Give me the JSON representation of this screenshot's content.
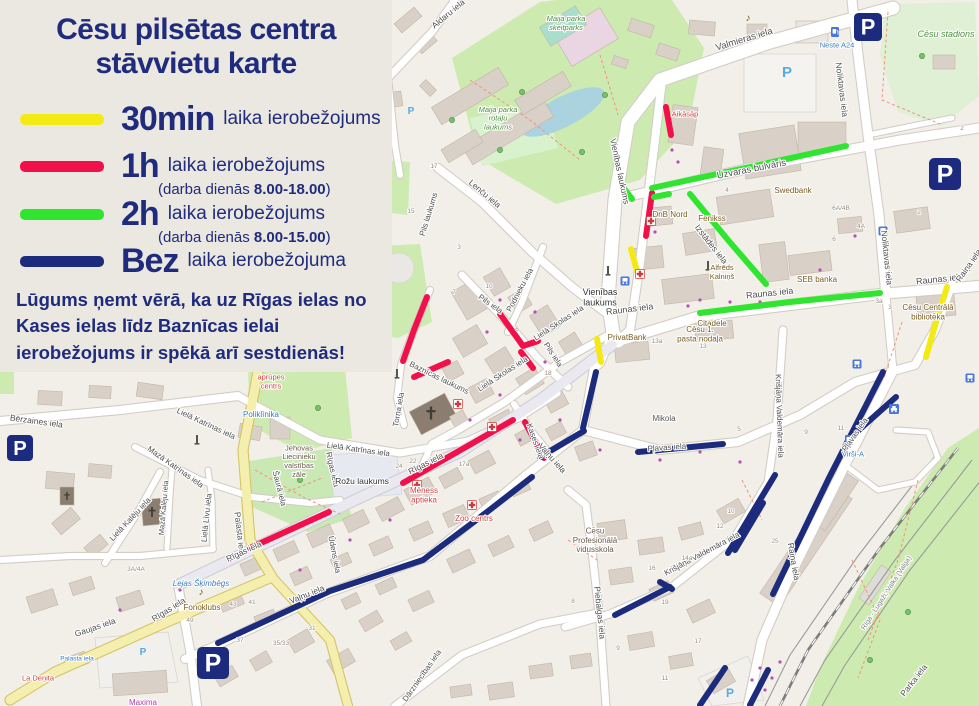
{
  "legend": {
    "title_line1": "Cēsu pilsētas centra",
    "title_line2": "stāvvietu karte",
    "items": [
      {
        "key": "30min",
        "color": "#f3ea15",
        "label_big": "30min",
        "label_rest": "laika ierobežojums"
      },
      {
        "key": "1h",
        "color": "#f2104a",
        "label_big": "1h",
        "label_rest": "laika ierobežojums",
        "note_pre": "(darba dienās ",
        "note_bold": "8.00-18.00",
        "note_post": ")"
      },
      {
        "key": "2h",
        "color": "#2fe52f",
        "label_big": "2h",
        "label_rest": "laika ierobežojums",
        "note_pre": "(darba dienās ",
        "note_bold": "8.00-15.00",
        "note_post": ")"
      },
      {
        "key": "bez",
        "color": "#1d2b7c",
        "label_big": "Bez",
        "label_rest": "laika ierobežojuma"
      }
    ],
    "note": "Lūgums ņemt vērā, ka uz Rīgas ielas no Kases ielas līdz Baznīcas ielai ierobežojums ir spēkā arī sestdienās!"
  },
  "colors": {
    "30min": "#f3ea15",
    "1h": "#f2104a",
    "2h": "#2fe52f",
    "bez": "#1d2b7c",
    "panel": "#ebe7e1",
    "navy_text": "#1f2c7d"
  },
  "map": {
    "parking_segments": [
      {
        "k": "30min",
        "p": [
          [
            631,
            249
          ],
          [
            637,
            271
          ]
        ]
      },
      {
        "k": "30min",
        "p": [
          [
            597,
            339
          ],
          [
            601,
            362
          ]
        ]
      },
      {
        "k": "30min",
        "p": [
          [
            947,
            287
          ],
          [
            936,
            322
          ],
          [
            926,
            357
          ]
        ]
      },
      {
        "k": "1h",
        "p": [
          [
            427,
            297
          ],
          [
            414,
            330
          ],
          [
            403,
            361
          ]
        ]
      },
      {
        "k": "1h",
        "p": [
          [
            414,
            377
          ],
          [
            448,
            362
          ]
        ]
      },
      {
        "k": "1h",
        "p": [
          [
            500,
            314
          ],
          [
            523,
            346
          ],
          [
            538,
            341
          ]
        ]
      },
      {
        "k": "1h",
        "p": [
          [
            521,
            352
          ],
          [
            533,
            368
          ]
        ]
      },
      {
        "k": "1h",
        "p": [
          [
            403,
            483
          ],
          [
            513,
            420
          ]
        ]
      },
      {
        "k": "1h",
        "p": [
          [
            525,
            422
          ],
          [
            544,
            458
          ]
        ]
      },
      {
        "k": "1h",
        "p": [
          [
            250,
            548
          ],
          [
            329,
            512
          ]
        ]
      },
      {
        "k": "1h",
        "p": [
          [
            666,
            107
          ],
          [
            671,
            135
          ]
        ]
      },
      {
        "k": "1h",
        "p": [
          [
            652,
            193
          ],
          [
            646,
            236
          ]
        ]
      },
      {
        "k": "2h",
        "p": [
          [
            652,
            188
          ],
          [
            750,
            167
          ],
          [
            846,
            146
          ]
        ]
      },
      {
        "k": "2h",
        "p": [
          [
            654,
            197
          ],
          [
            669,
            194
          ]
        ]
      },
      {
        "k": "2h",
        "p": [
          [
            622,
            186
          ],
          [
            632,
            199
          ]
        ]
      },
      {
        "k": "2h",
        "p": [
          [
            690,
            194
          ],
          [
            728,
            240
          ],
          [
            766,
            284
          ]
        ]
      },
      {
        "k": "2h",
        "p": [
          [
            700,
            313
          ],
          [
            790,
            302
          ],
          [
            880,
            293
          ]
        ]
      },
      {
        "k": "bez",
        "p": [
          [
            596,
            372
          ],
          [
            583,
            428
          ]
        ]
      },
      {
        "k": "bez",
        "p": [
          [
            584,
            431
          ],
          [
            540,
            457
          ]
        ]
      },
      {
        "k": "bez",
        "p": [
          [
            532,
            477
          ],
          [
            487,
            512
          ],
          [
            423,
            560
          ],
          [
            330,
            591
          ],
          [
            218,
            643
          ]
        ]
      },
      {
        "k": "bez",
        "p": [
          [
            638,
            452
          ],
          [
            723,
            444
          ]
        ]
      },
      {
        "k": "bez",
        "p": [
          [
            728,
            553
          ],
          [
            775,
            475
          ]
        ]
      },
      {
        "k": "bez",
        "p": [
          [
            883,
            372
          ],
          [
            829,
            478
          ],
          [
            773,
            594
          ]
        ]
      },
      {
        "k": "bez",
        "p": [
          [
            896,
            397
          ],
          [
            851,
            437
          ]
        ]
      },
      {
        "k": "bez",
        "p": [
          [
            763,
            503
          ],
          [
            735,
            550
          ]
        ]
      },
      {
        "k": "bez",
        "p": [
          [
            670,
            587
          ],
          [
            615,
            615
          ]
        ]
      },
      {
        "k": "bez",
        "p": [
          [
            725,
            668
          ],
          [
            700,
            705
          ]
        ]
      },
      {
        "k": "bez",
        "p": [
          [
            768,
            670
          ],
          [
            750,
            705
          ]
        ]
      },
      {
        "k": "bez",
        "p": [
          [
            660,
            582
          ],
          [
            672,
            589
          ]
        ]
      }
    ],
    "street_labels": [
      [
        "Valmieras iela",
        745,
        42,
        -17,
        9.5
      ],
      [
        "Aldaru iela",
        450,
        16,
        -40,
        8.5
      ],
      [
        "Noliktavas iela",
        839,
        90,
        83,
        8.5
      ],
      [
        "Noliktavas iela",
        884,
        258,
        84,
        8.5
      ],
      [
        "Uzvaras bulvāris",
        752,
        172,
        -11,
        9.5
      ],
      [
        "Vienības laukums",
        617,
        172,
        78,
        8.5
      ],
      [
        "Izstādes iela",
        709,
        246,
        52,
        8.5
      ],
      [
        "Raunas iela",
        630,
        312,
        -7,
        9
      ],
      [
        "Raunas iela",
        770,
        296,
        -6,
        9
      ],
      [
        "Raunas iela",
        940,
        282,
        -6,
        9
      ],
      [
        "Lenču iela",
        483,
        196,
        40,
        8.5
      ],
      [
        "Pils laukums",
        431,
        215,
        -73,
        8
      ],
      [
        "Pils iela",
        489,
        306,
        35,
        8
      ],
      [
        "Pils iela",
        551,
        356,
        57,
        8
      ],
      [
        "Podnieku iela",
        522,
        291,
        -62,
        8
      ],
      [
        "Lielā Skolas iela",
        560,
        325,
        -33,
        8
      ],
      [
        "Lielā Skolas iela",
        504,
        376,
        -33,
        8
      ],
      [
        "Baznīcas laukums",
        438,
        380,
        26,
        8
      ],
      [
        "Torņa iela",
        401,
        410,
        -80,
        8
      ],
      [
        "Lielā Katrīnas iela",
        205,
        426,
        25,
        8
      ],
      [
        "Lielā Katrīnas iela",
        358,
        452,
        8,
        8
      ],
      [
        "Mazā Katrīnas iela",
        174,
        469,
        35,
        8
      ],
      [
        "Lielā Kalēju iela",
        132,
        521,
        -47,
        8
      ],
      [
        "Mazā Kalēju iela",
        166,
        508,
        -85,
        7.5
      ],
      [
        "Lielā Līvu iela",
        209,
        518,
        -84,
        8
      ],
      [
        "Šaurā iela",
        277,
        489,
        76,
        8
      ],
      [
        "Bērzaines iela",
        36,
        424,
        8,
        8.5
      ],
      [
        "Palasta iela",
        237,
        534,
        83,
        8.5
      ],
      [
        "Gaujas iela",
        96,
        630,
        -19,
        8.5
      ],
      [
        "Rīgas iela",
        427,
        466,
        -27,
        8.5
      ],
      [
        "Rīgas iela",
        245,
        554,
        -25,
        8.5
      ],
      [
        "Rīgas iela",
        170,
        612,
        -32,
        8.5
      ],
      [
        "Rīgas iela",
        330,
        470,
        77,
        8
      ],
      [
        "Kases iela",
        533,
        442,
        70,
        8
      ],
      [
        "Vaļņu iela",
        550,
        460,
        48,
        8.5
      ],
      [
        "Vaļņu iela",
        308,
        597,
        -22,
        8.5
      ],
      [
        "Ūdens iela",
        332,
        555,
        79,
        8
      ],
      [
        "Dārzniecības iela",
        424,
        677,
        -55,
        8
      ],
      [
        "Piebalgas iela",
        597,
        613,
        84,
        8.5
      ],
      [
        "Krišjāņa Valdemāra iela",
        777,
        416,
        88,
        8
      ],
      [
        "Krišjāņa Valdemāra iela",
        703,
        556,
        -28,
        8
      ],
      [
        "Raiņa iela",
        791,
        562,
        80,
        8.5
      ],
      [
        "Raiņa iela",
        971,
        267,
        -55,
        8.5
      ],
      [
        "Pļavas iela",
        667,
        450,
        -4,
        8
      ],
      [
        "Pļavas iela",
        857,
        436,
        -55,
        8
      ],
      [
        "Parka iela",
        916,
        682,
        -52,
        8.5
      ]
    ],
    "poi_labels": [
      {
        "lines": [
          "Neste A24"
        ],
        "x": 837,
        "y": 45,
        "s": 7.5,
        "c": "#3a7ac2"
      },
      {
        "lines": [
          "Cēsu stadions"
        ],
        "x": 946,
        "y": 34,
        "s": 9,
        "c": "#4e8f3e",
        "i": 1
      },
      {
        "lines": [
          "Maija parka",
          "skeitparks"
        ],
        "x": 566,
        "y": 23,
        "s": 7.5,
        "c": "#4e8f3e",
        "i": 1
      },
      {
        "lines": [
          "Maija parka",
          "rotaļu",
          "laukums"
        ],
        "x": 498,
        "y": 118,
        "s": 7.5,
        "c": "#4e8f3e",
        "i": 1
      },
      {
        "lines": [
          "Aikāsāp"
        ],
        "x": 685,
        "y": 114,
        "s": 7.5,
        "c": "#d43f3f"
      },
      {
        "lines": [
          "Swedbank"
        ],
        "x": 793,
        "y": 190,
        "s": 8,
        "c": "#7a5b1e"
      },
      {
        "lines": [
          "DnB Nord"
        ],
        "x": 670,
        "y": 214,
        "s": 8,
        "c": "#7a5b1e"
      },
      {
        "lines": [
          "Fenikss"
        ],
        "x": 712,
        "y": 218,
        "s": 8,
        "c": "#7a5b1e"
      },
      {
        "lines": [
          "SEB banka"
        ],
        "x": 817,
        "y": 279,
        "s": 8,
        "c": "#7a5b1e"
      },
      {
        "lines": [
          "Alfrēds",
          "Kalniņš"
        ],
        "x": 722,
        "y": 272,
        "s": 7.5,
        "c": "#7a5b1e"
      },
      {
        "lines": [
          "Citadele"
        ],
        "x": 712,
        "y": 323,
        "s": 8,
        "c": "#7a5b1e"
      },
      {
        "lines": [
          "Cēsu 1.",
          "pasta nodaļa"
        ],
        "x": 700,
        "y": 334,
        "s": 8,
        "c": "#7a5b1e"
      },
      {
        "lines": [
          "PrivatBank"
        ],
        "x": 627,
        "y": 337,
        "s": 8,
        "c": "#7a5b1e"
      },
      {
        "lines": [
          "Cēsu Centrālā",
          "bibliotēka"
        ],
        "x": 928,
        "y": 312,
        "s": 8,
        "c": "#7a5b1e"
      },
      {
        "lines": [
          "Mikola"
        ],
        "x": 664,
        "y": 418,
        "s": 8,
        "c": "#555555"
      },
      {
        "lines": [
          "Virši-A"
        ],
        "x": 853,
        "y": 454,
        "s": 7.5,
        "c": "#3a7ac2"
      },
      {
        "lines": [
          "Cēsu veselības",
          "aprūpes",
          "centrs"
        ],
        "x": 271,
        "y": 377,
        "s": 7.5,
        "c": "#d43f3f"
      },
      {
        "lines": [
          "Poliklīnika"
        ],
        "x": 261,
        "y": 414,
        "s": 8,
        "c": "#3a7ac2"
      },
      {
        "lines": [
          "Jehovas",
          "Liecinieku",
          "valstības",
          "zāle"
        ],
        "x": 299,
        "y": 461,
        "s": 7.5,
        "c": "#6a5b49"
      },
      {
        "lines": [
          "Rožu laukums"
        ],
        "x": 362,
        "y": 481,
        "s": 8.5,
        "c": "#333333"
      },
      {
        "lines": [
          "Vienības",
          "laukums"
        ],
        "x": 600,
        "y": 297,
        "s": 9,
        "c": "#333333"
      },
      {
        "lines": [
          "Mēness",
          "aptieka"
        ],
        "x": 424,
        "y": 495,
        "s": 8,
        "c": "#d43f3f"
      },
      {
        "lines": [
          "Zoo centrs"
        ],
        "x": 474,
        "y": 518,
        "s": 8,
        "c": "#d43f3f"
      },
      {
        "lines": [
          "Cēsu",
          "Profesionālā",
          "vidusskola"
        ],
        "x": 595,
        "y": 540,
        "s": 8,
        "c": "#6a5b49"
      },
      {
        "lines": [
          "Lejas Šķimbēgs"
        ],
        "x": 201,
        "y": 583,
        "s": 8,
        "c": "#3a7ac2",
        "i": 1
      },
      {
        "lines": [
          "Fonoklubs"
        ],
        "x": 202,
        "y": 607,
        "s": 8,
        "c": "#7a5b1e"
      },
      {
        "lines": [
          "La Deņita"
        ],
        "x": 38,
        "y": 678,
        "s": 7.5,
        "c": "#d43f3f"
      },
      {
        "lines": [
          "Maxima"
        ],
        "x": 143,
        "y": 702,
        "s": 8,
        "c": "#b33ab3"
      },
      {
        "lines": [
          "Palasta iela"
        ],
        "x": 77,
        "y": 658,
        "s": 6.5,
        "c": "#3a7ac2"
      }
    ],
    "house_numbers": [
      [
        "17",
        434,
        168
      ],
      [
        "15",
        411,
        213
      ],
      [
        "3",
        459,
        249
      ],
      [
        "10",
        489,
        288
      ],
      [
        "7",
        454,
        294
      ],
      [
        "6",
        517,
        331
      ],
      [
        "18",
        548,
        375
      ],
      [
        "24",
        399,
        468
      ],
      [
        "22",
        413,
        463
      ],
      [
        "17a",
        464,
        466
      ],
      [
        "13a",
        657,
        343
      ],
      [
        "13",
        703,
        348
      ],
      [
        "4",
        727,
        192
      ],
      [
        "6A/4B",
        841,
        210
      ],
      [
        "4A",
        861,
        228
      ],
      [
        "6",
        834,
        241
      ],
      [
        "2",
        919,
        214
      ],
      [
        "3a",
        879,
        303
      ],
      [
        "3",
        890,
        309
      ],
      [
        "25",
        775,
        543
      ],
      [
        "9",
        806,
        434
      ],
      [
        "11",
        841,
        430
      ],
      [
        "5",
        739,
        431
      ],
      [
        "12",
        720,
        528
      ],
      [
        "10",
        731,
        513
      ],
      [
        "49",
        190,
        622
      ],
      [
        "37",
        240,
        642
      ],
      [
        "43",
        233,
        606
      ],
      [
        "41",
        252,
        604
      ],
      [
        "35/33",
        281,
        645
      ],
      [
        "31",
        312,
        630
      ],
      [
        "3A/4A",
        136,
        571
      ],
      [
        "16",
        652,
        570
      ],
      [
        "14a",
        687,
        560
      ],
      [
        "8",
        573,
        603
      ],
      [
        "19",
        665,
        604
      ],
      [
        "17",
        698,
        643
      ],
      [
        "11",
        665,
        680
      ],
      [
        "9",
        618,
        650
      ],
      [
        "2",
        962,
        130
      ]
    ],
    "parking_icons": [
      [
        868,
        27,
        28
      ],
      [
        945,
        174,
        32
      ],
      [
        20,
        448,
        26
      ],
      [
        213,
        663,
        32
      ]
    ],
    "small_p_marks": [
      [
        787,
        77,
        15
      ],
      [
        411,
        114,
        10
      ],
      [
        143,
        655,
        10
      ],
      [
        730,
        697,
        12
      ]
    ],
    "bus_stops": [
      [
        883,
        231
      ],
      [
        625,
        281
      ],
      [
        857,
        364
      ],
      [
        970,
        378
      ]
    ],
    "taxi_stands": [
      [
        894,
        409
      ]
    ],
    "fuel_stations": [
      [
        835,
        32
      ],
      [
        849,
        440
      ]
    ],
    "pharmacies": [
      [
        417,
        485
      ],
      [
        472,
        505
      ],
      [
        651,
        221
      ],
      [
        640,
        274
      ],
      [
        458,
        404
      ],
      [
        492,
        427
      ]
    ],
    "churches": [
      [
        431,
        413,
        13
      ],
      [
        152,
        512,
        10
      ],
      [
        67,
        496,
        8
      ]
    ],
    "music_venues": [
      [
        201,
        595
      ],
      [
        748,
        21
      ]
    ],
    "monuments": [
      [
        608,
        271
      ],
      [
        197,
        440
      ],
      [
        397,
        374
      ],
      [
        708,
        266
      ]
    ],
    "railway_label": {
      "text": "Rīga - Lugaži; Valka (Valga)",
      "x": 888,
      "y": 594,
      "r": -57
    }
  }
}
